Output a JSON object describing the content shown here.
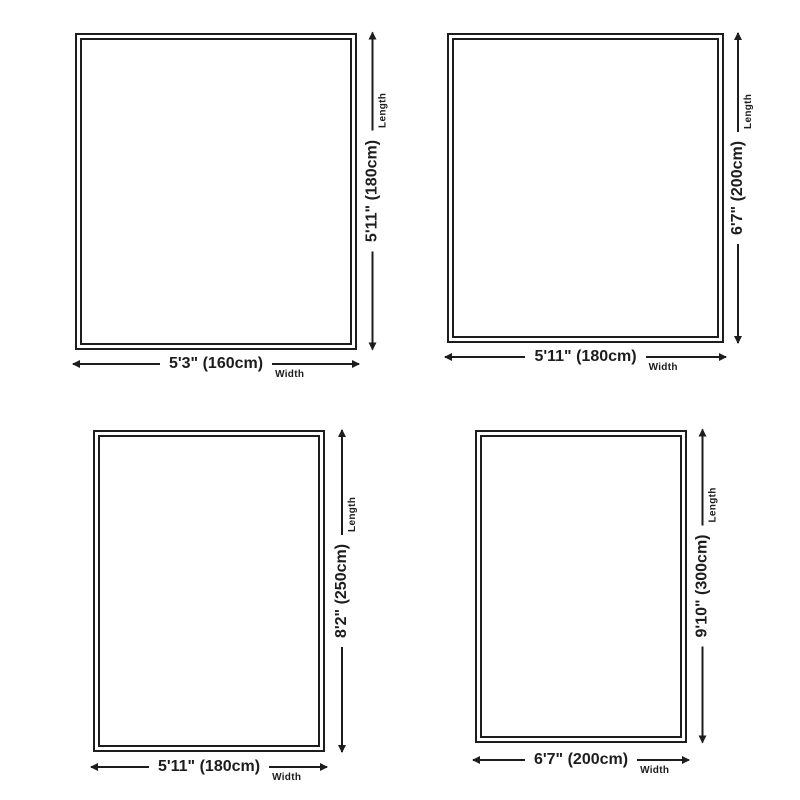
{
  "diagram": {
    "background_color": "#ffffff",
    "line_color": "#1d1d1d",
    "panels": [
      {
        "name": "rug-size-160x180",
        "width_label": "5'3\" (160cm)",
        "length_label": "5'11\" (180cm)",
        "width_caption": "Width",
        "length_caption": "Length"
      },
      {
        "name": "rug-size-180x200",
        "width_label": "5'11\" (180cm)",
        "length_label": "6'7\" (200cm)",
        "width_caption": "Width",
        "length_caption": "Length"
      },
      {
        "name": "rug-size-180x250",
        "width_label": "5'11\" (180cm)",
        "length_label": "8'2\" (250cm)",
        "width_caption": "Width",
        "length_caption": "Length"
      },
      {
        "name": "rug-size-200x300",
        "width_label": "6'7\" (200cm)",
        "length_label": "9'10\" (300cm)",
        "width_caption": "Width",
        "length_caption": "Length"
      }
    ]
  }
}
